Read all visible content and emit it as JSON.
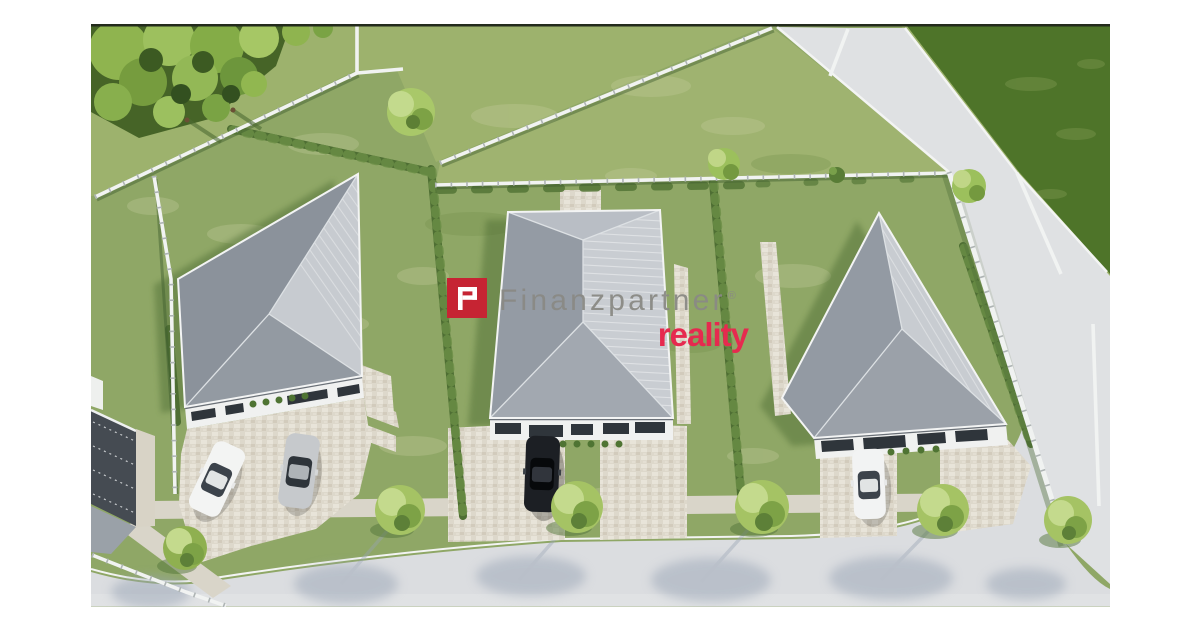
{
  "image": {
    "description": "Aerial drone view of three newly built single-storey houses with grey hip roofs on fenced green plots separated by hedges, with paved driveways, four parked cars, street trees and a curving light-grey access road in front; large trees in the top-left corner and darker meadows behind the back fences."
  },
  "watermark": {
    "brand": "Finanzpartner",
    "registered_mark": "®",
    "sub_brand": "reality",
    "monogram": "FP",
    "colors": {
      "logo_square": "#c62433",
      "brand_text": "#8a8a85",
      "sub_brand_text": "#e62a4f"
    }
  }
}
